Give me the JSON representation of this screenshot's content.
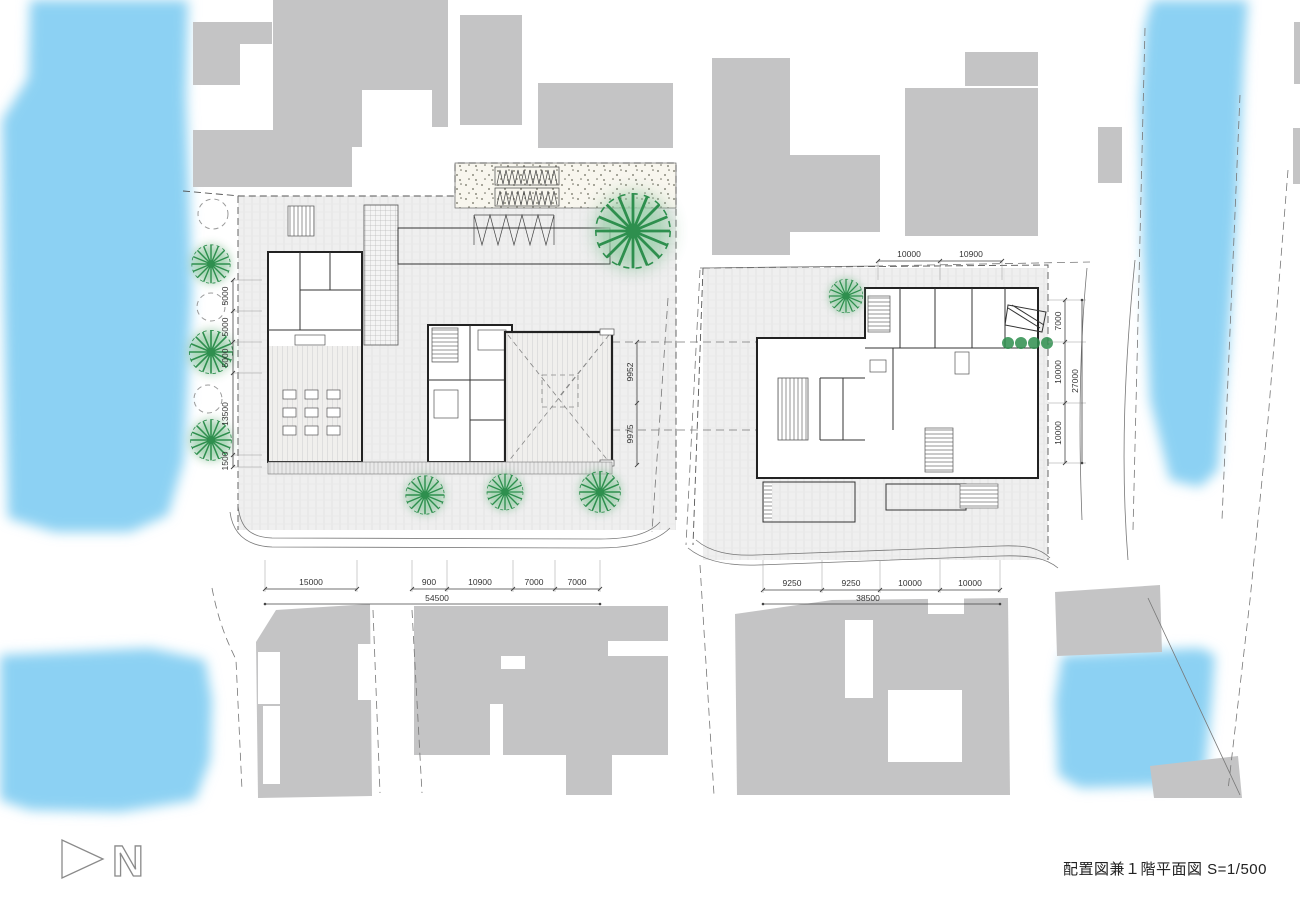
{
  "title": "配置図兼１階平面図 S=1/500",
  "north_label": "N",
  "colors": {
    "water": "#8CD1F3",
    "context_building": "#C4C4C5",
    "tree": "#2E8F4E",
    "tree_fill": "#A5D6B4",
    "paving": "#EDEDED"
  },
  "dimensions": {
    "left_vertical": [
      "5000",
      "5000",
      "5000",
      "13500",
      "1500"
    ],
    "bottom_left": [
      "15000",
      "900",
      "10900",
      "7000",
      "7000"
    ],
    "bottom_left_total": "54500",
    "bottom_right": [
      "9250",
      "9250",
      "10000",
      "10000"
    ],
    "bottom_right_total": "38500",
    "right_top": [
      "10000",
      "10900"
    ],
    "right_vertical": [
      "7000",
      "10000",
      "10000"
    ],
    "right_vertical_total": "27000",
    "center_vertical": [
      "9952",
      "9975"
    ]
  }
}
